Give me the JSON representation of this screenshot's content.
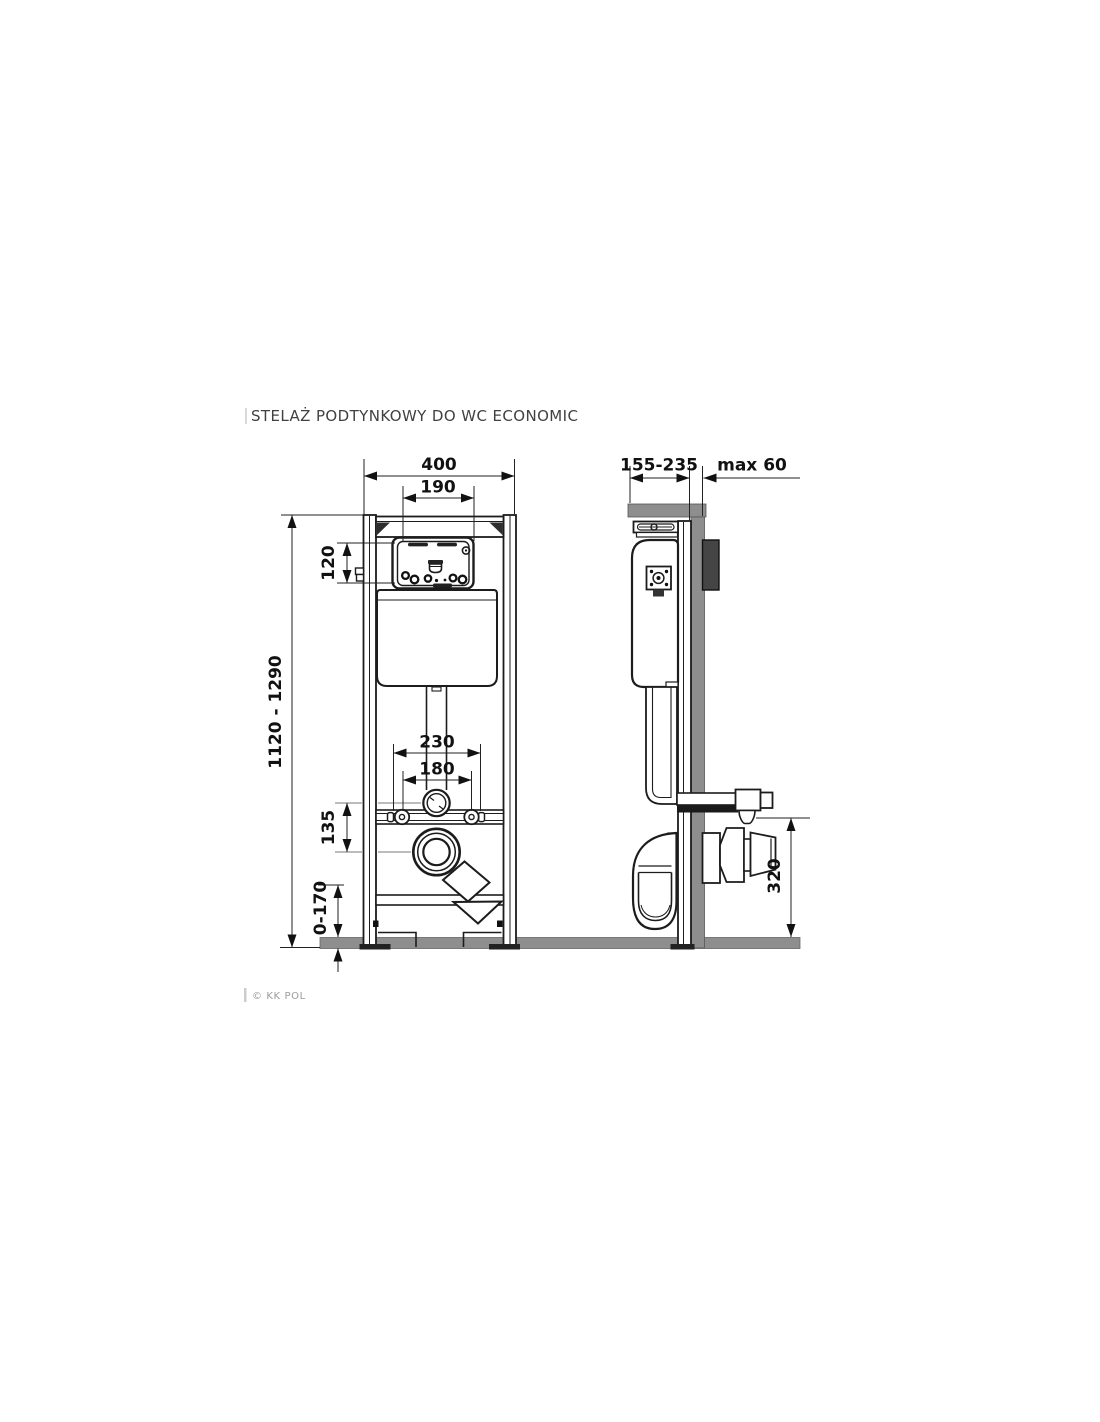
{
  "title": "STELAŻ PODTYNKOWY DO WC ECONOMIC",
  "copyright": "© KK POL",
  "front_view": {
    "name": "front view",
    "dims": {
      "overall_width": "400",
      "panel_width": "190",
      "panel_height": "120",
      "frame_height": "1120 - 1290",
      "outer_bolt_spacing": "230",
      "bolt_spacing": "180",
      "pipe_offset": "135",
      "leg_adjustment": "0-170"
    }
  },
  "side_view": {
    "name": "side view",
    "dims": {
      "mounting_depth": "155-235",
      "wall_offset": "max 60",
      "outlet_height": "320"
    }
  },
  "colors": {
    "line": "#1c1c1c",
    "masonry": "#8e8e8e",
    "bracket_block": "#454545"
  }
}
